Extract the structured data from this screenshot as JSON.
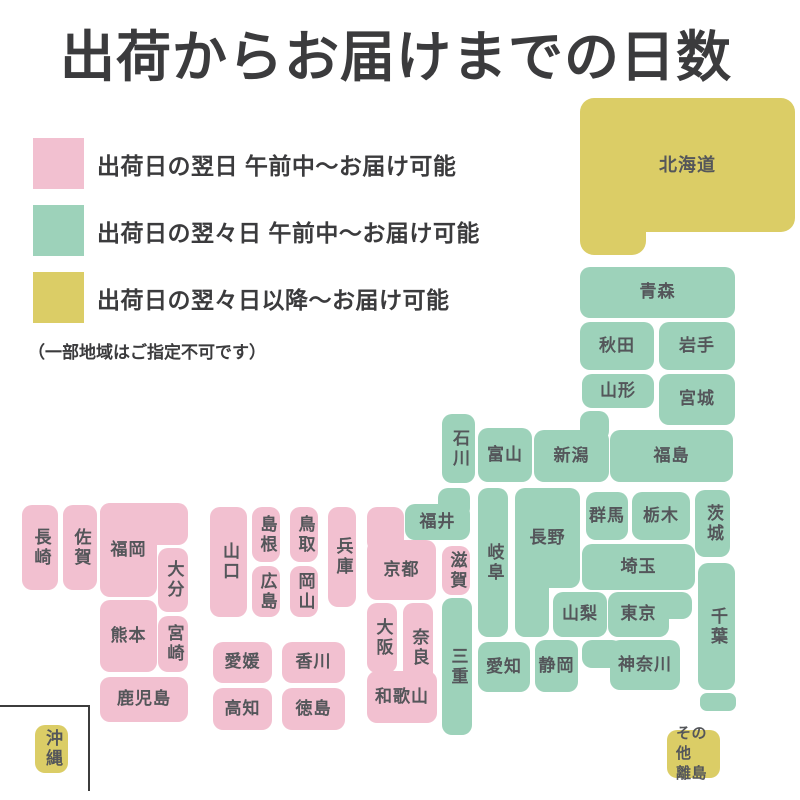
{
  "title": "出荷からお届けまでの日数",
  "legend": {
    "items": [
      {
        "key": "pink",
        "label": "出荷日の翌日 午前中〜お届け可能"
      },
      {
        "key": "green",
        "label": "出荷日の翌々日 午前中〜お届け可能"
      },
      {
        "key": "yellow",
        "label": "出荷日の翌々日以降〜お届け可能"
      }
    ],
    "note": "（一部地域はご指定不可です）"
  },
  "colors": {
    "pink": "#F2C0D0",
    "green": "#9DD2BA",
    "yellow": "#DBCD66",
    "label_text": "#54565A",
    "heading_text": "#3B3B3D"
  },
  "map": {
    "prefectures": [
      {
        "id": "hokkaido",
        "name": "北海道",
        "color": "yellow",
        "orient": "h",
        "rect": [
          580,
          98,
          215,
          134
        ],
        "ext": [
          [
            580,
            160,
            66,
            95
          ]
        ],
        "fs": 18,
        "radius": 14
      },
      {
        "id": "aomori",
        "name": "青森",
        "color": "green",
        "orient": "h",
        "rect": [
          580,
          267,
          155,
          51
        ]
      },
      {
        "id": "akita",
        "name": "秋田",
        "color": "green",
        "orient": "h",
        "rect": [
          580,
          322,
          74,
          48
        ]
      },
      {
        "id": "iwate",
        "name": "岩手",
        "color": "green",
        "orient": "h",
        "rect": [
          659,
          322,
          76,
          48
        ]
      },
      {
        "id": "yamagata",
        "name": "山形",
        "color": "green",
        "orient": "h",
        "rect": [
          582,
          374,
          72,
          34
        ]
      },
      {
        "id": "miyagi",
        "name": "宮城",
        "color": "green",
        "orient": "h",
        "rect": [
          659,
          374,
          76,
          51
        ]
      },
      {
        "id": "fukushima",
        "name": "福島",
        "color": "green",
        "orient": "h",
        "rect": [
          610,
          430,
          123,
          52
        ]
      },
      {
        "id": "niigata",
        "name": "新潟",
        "color": "green",
        "orient": "h",
        "rect": [
          534,
          430,
          75,
          52
        ],
        "ext": [
          [
            580,
            411,
            29,
            30
          ]
        ]
      },
      {
        "id": "toyama",
        "name": "富山",
        "color": "green",
        "orient": "h",
        "rect": [
          478,
          428,
          54,
          54
        ]
      },
      {
        "id": "ishikawa",
        "name": "石川",
        "color": "green",
        "orient": "v",
        "rect": [
          442,
          414,
          33,
          69
        ]
      },
      {
        "id": "fukui",
        "name": "福井",
        "color": "green",
        "orient": "h",
        "rect": [
          405,
          504,
          65,
          36
        ],
        "ext": [
          [
            438,
            488,
            32,
            30
          ]
        ]
      },
      {
        "id": "gunma",
        "name": "群馬",
        "color": "green",
        "orient": "h",
        "rect": [
          586,
          492,
          42,
          48
        ]
      },
      {
        "id": "tochigi",
        "name": "栃木",
        "color": "green",
        "orient": "h",
        "rect": [
          632,
          492,
          58,
          48
        ]
      },
      {
        "id": "ibaraki",
        "name": "茨城",
        "color": "green",
        "orient": "v",
        "rect": [
          695,
          490,
          35,
          67
        ]
      },
      {
        "id": "saitama",
        "name": "埼玉",
        "color": "green",
        "orient": "h",
        "rect": [
          582,
          544,
          113,
          46
        ]
      },
      {
        "id": "nagano",
        "name": "長野",
        "color": "green",
        "orient": "h",
        "rect": [
          515,
          488,
          65,
          100
        ],
        "ext": [
          [
            515,
            560,
            34,
            77
          ]
        ]
      },
      {
        "id": "gifu",
        "name": "岐阜",
        "color": "green",
        "orient": "v",
        "rect": [
          478,
          488,
          30,
          149
        ]
      },
      {
        "id": "yamanashi",
        "name": "山梨",
        "color": "green",
        "orient": "h",
        "rect": [
          553,
          592,
          54,
          45
        ]
      },
      {
        "id": "tokyo",
        "name": "東京",
        "color": "green",
        "orient": "h",
        "rect": [
          608,
          592,
          61,
          45
        ],
        "ext": [
          [
            640,
            592,
            52,
            27
          ]
        ]
      },
      {
        "id": "chiba",
        "name": "千葉",
        "color": "green",
        "orient": "v",
        "rect": [
          698,
          563,
          37,
          127
        ]
      },
      {
        "id": "kanagawa",
        "name": "神奈川",
        "color": "green",
        "orient": "h",
        "rect": [
          610,
          640,
          70,
          50
        ],
        "ext": [
          [
            582,
            640,
            40,
            28
          ]
        ]
      },
      {
        "id": "shizuoka",
        "name": "静岡",
        "color": "green",
        "orient": "h",
        "rect": [
          535,
          640,
          43,
          52
        ]
      },
      {
        "id": "aichi",
        "name": "愛知",
        "color": "green",
        "orient": "h",
        "rect": [
          478,
          642,
          52,
          50
        ]
      },
      {
        "id": "mie",
        "name": "三重",
        "color": "green",
        "orient": "v",
        "rect": [
          442,
          598,
          30,
          137
        ]
      },
      {
        "id": "islands",
        "name": "",
        "color": "green",
        "orient": "h",
        "rect": [
          700,
          693,
          36,
          18
        ],
        "radius": 7
      },
      {
        "id": "shiga",
        "name": "滋賀",
        "color": "pink",
        "orient": "v",
        "rect": [
          442,
          546,
          28,
          49
        ]
      },
      {
        "id": "kyoto",
        "name": "京都",
        "color": "pink",
        "orient": "h",
        "rect": [
          367,
          540,
          69,
          60
        ],
        "ext": [
          [
            367,
            507,
            37,
            45
          ]
        ]
      },
      {
        "id": "hyogo",
        "name": "兵庫",
        "color": "pink",
        "orient": "v",
        "rect": [
          328,
          507,
          28,
          100
        ]
      },
      {
        "id": "osaka",
        "name": "大阪",
        "color": "pink",
        "orient": "v",
        "rect": [
          367,
          603,
          30,
          70
        ]
      },
      {
        "id": "nara",
        "name": "奈良",
        "color": "pink",
        "orient": "v",
        "rect": [
          403,
          603,
          30,
          90
        ]
      },
      {
        "id": "wakayama",
        "name": "和歌山",
        "color": "pink",
        "orient": "h",
        "rect": [
          367,
          671,
          70,
          52
        ]
      },
      {
        "id": "tottori",
        "name": "鳥取",
        "color": "pink",
        "orient": "v",
        "rect": [
          290,
          507,
          28,
          55
        ]
      },
      {
        "id": "shimane",
        "name": "島根",
        "color": "pink",
        "orient": "v",
        "rect": [
          252,
          507,
          28,
          55
        ]
      },
      {
        "id": "okayama",
        "name": "岡山",
        "color": "pink",
        "orient": "v",
        "rect": [
          290,
          566,
          28,
          51
        ]
      },
      {
        "id": "hiroshima",
        "name": "広島",
        "color": "pink",
        "orient": "v",
        "rect": [
          252,
          566,
          28,
          51
        ]
      },
      {
        "id": "yamaguchi",
        "name": "山口",
        "color": "pink",
        "orient": "v",
        "rect": [
          210,
          507,
          37,
          110
        ]
      },
      {
        "id": "ehime",
        "name": "愛媛",
        "color": "pink",
        "orient": "h",
        "rect": [
          213,
          642,
          59,
          41
        ]
      },
      {
        "id": "kagawa",
        "name": "香川",
        "color": "pink",
        "orient": "h",
        "rect": [
          282,
          642,
          63,
          41
        ]
      },
      {
        "id": "kochi",
        "name": "高知",
        "color": "pink",
        "orient": "h",
        "rect": [
          213,
          688,
          59,
          42
        ]
      },
      {
        "id": "tokushima",
        "name": "徳島",
        "color": "pink",
        "orient": "h",
        "rect": [
          282,
          688,
          63,
          42
        ]
      },
      {
        "id": "fukuoka",
        "name": "福岡",
        "color": "pink",
        "orient": "h",
        "rect": [
          100,
          503,
          57,
          94
        ],
        "ext": [
          [
            100,
            503,
            88,
            42
          ]
        ]
      },
      {
        "id": "saga",
        "name": "佐賀",
        "color": "pink",
        "orient": "v",
        "rect": [
          63,
          505,
          34,
          85
        ]
      },
      {
        "id": "nagasaki",
        "name": "長崎",
        "color": "pink",
        "orient": "v",
        "rect": [
          22,
          505,
          36,
          85
        ]
      },
      {
        "id": "oita",
        "name": "大分",
        "color": "pink",
        "orient": "v",
        "rect": [
          158,
          548,
          30,
          64
        ]
      },
      {
        "id": "kumamoto",
        "name": "熊本",
        "color": "pink",
        "orient": "h",
        "rect": [
          100,
          600,
          57,
          72
        ]
      },
      {
        "id": "miyazaki",
        "name": "宮崎",
        "color": "pink",
        "orient": "v",
        "rect": [
          158,
          616,
          30,
          56
        ]
      },
      {
        "id": "kagoshima",
        "name": "鹿児島",
        "color": "pink",
        "orient": "h",
        "rect": [
          100,
          677,
          88,
          45
        ]
      },
      {
        "id": "okinawa",
        "name": "沖縄",
        "color": "yellow",
        "orient": "v",
        "rect": [
          35,
          725,
          33,
          48
        ]
      },
      {
        "id": "other-islands",
        "name": "その他\n離島",
        "color": "yellow",
        "orient": "h2",
        "rect": [
          667,
          730,
          53,
          48
        ]
      }
    ]
  }
}
